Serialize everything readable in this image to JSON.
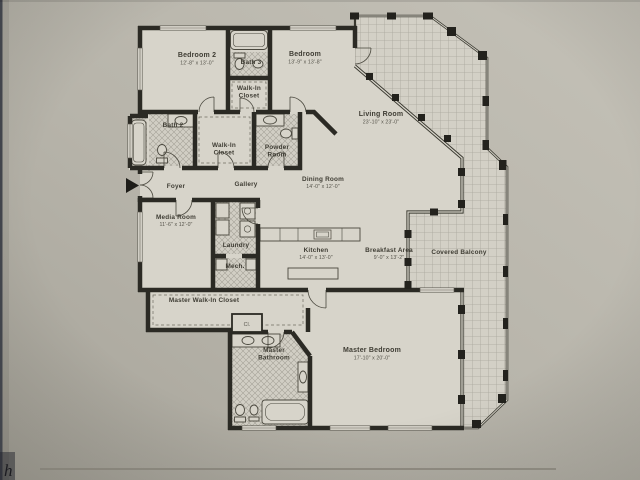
{
  "photo": {
    "corner_mark": "h"
  },
  "plan": {
    "rooms": {
      "bedroom2": {
        "name": "Bedroom 2",
        "dims": "12'-8\" x 13'-0\""
      },
      "bath3": {
        "name": "Bath 3"
      },
      "bedroom": {
        "name": "Bedroom",
        "dims": "13'-9\" x 13'-8\""
      },
      "walkin_closet_top": {
        "line1": "Walk-In",
        "line2": "Closet"
      },
      "bath2": {
        "name": "Bath 2"
      },
      "walkin_closet_mid": {
        "line1": "Walk-In",
        "line2": "Closet"
      },
      "powder": {
        "line1": "Powder",
        "line2": "Room"
      },
      "living": {
        "name": "Living Room",
        "dims": "23'-10\" x 23'-0\""
      },
      "foyer": {
        "name": "Foyer"
      },
      "gallery": {
        "name": "Gallery"
      },
      "dining": {
        "name": "Dining Room",
        "dims": "14'-0\" x 12'-0\""
      },
      "media": {
        "name": "Media Room",
        "dims": "11'-6\" x 12'-0\""
      },
      "laundry": {
        "name": "Laundry"
      },
      "mech": {
        "name": "Mech."
      },
      "kitchen": {
        "name": "Kitchen",
        "dims": "14'-0\" x 13'-0\""
      },
      "breakfast": {
        "name": "Breakfast Area",
        "dims": "9'-0\" x 13'-2\""
      },
      "balcony": {
        "name": "Covered Balcony"
      },
      "master_wic": {
        "name": "Master Walk-In Closet"
      },
      "cl": {
        "name": "Cl."
      },
      "master_bath": {
        "line1": "Master",
        "line2": "Bathroom"
      },
      "master_bedroom": {
        "name": "Master Bedroom",
        "dims": "17'-10\" x 20'-0\""
      }
    },
    "colors": {
      "paper": "#b6b3a9",
      "floor": "#d7d4ca",
      "wall": "#2b2a24",
      "balcony_grid": "#a9a69c",
      "fixture_line": "#4a483e"
    }
  }
}
